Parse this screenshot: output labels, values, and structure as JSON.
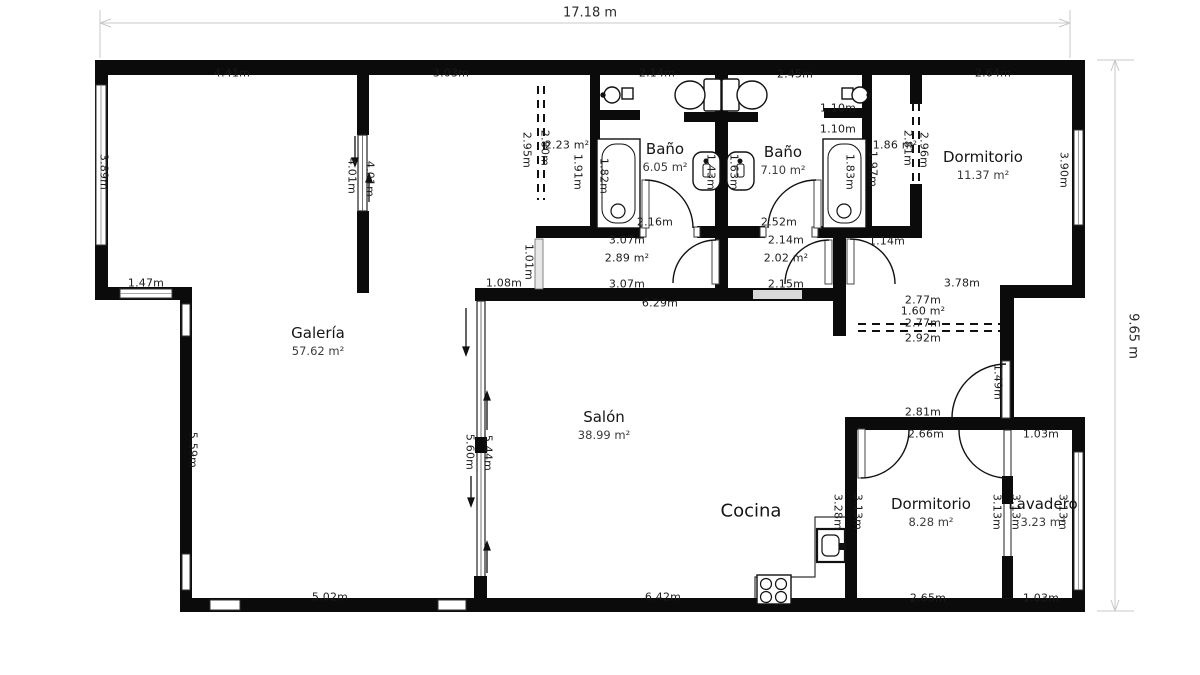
{
  "plan": {
    "overall": {
      "width_label": "17.18 m",
      "height_label": "9.65 m"
    },
    "colors": {
      "wall": "#0b0b0b",
      "dim_line": "#c8c8c8",
      "opening": "#d9d9d9"
    },
    "rooms": [
      {
        "name": "Galería",
        "area": "57.62 m²",
        "x": 318,
        "y": 341
      },
      {
        "name": "Baño",
        "area": "6.05 m²",
        "x": 665,
        "y": 157
      },
      {
        "name": "Baño",
        "area": "7.10 m²",
        "x": 783,
        "y": 160
      },
      {
        "name": "Dormitorio",
        "area": "11.37 m²",
        "x": 983,
        "y": 165
      },
      {
        "name": "Salón",
        "area": "38.99 m²",
        "x": 604,
        "y": 425
      },
      {
        "name": "Cocina",
        "area": "",
        "x": 751,
        "y": 511,
        "big": true
      },
      {
        "name": "Dormitorio",
        "area": "8.28 m²",
        "x": 931,
        "y": 512
      },
      {
        "name": "Lavadero",
        "area": "3.23 m²",
        "x": 1043,
        "y": 512
      }
    ],
    "dim_labels": [
      {
        "t": "4.41m",
        "x": 232,
        "y": 73
      },
      {
        "t": "3.03m",
        "x": 451,
        "y": 73
      },
      {
        "t": "2.14m",
        "x": 657,
        "y": 73
      },
      {
        "t": "2.45m",
        "x": 795,
        "y": 74
      },
      {
        "t": "2.64m",
        "x": 993,
        "y": 73
      },
      {
        "t": "2.23 m²",
        "x": 567,
        "y": 145
      },
      {
        "t": "2.95m",
        "x": 527,
        "y": 150,
        "r": 1
      },
      {
        "t": "2.80m",
        "x": 545,
        "y": 148,
        "r": 1
      },
      {
        "t": "1.91m",
        "x": 578,
        "y": 172,
        "r": 1
      },
      {
        "t": "1.82m",
        "x": 604,
        "y": 176,
        "r": 1
      },
      {
        "t": "4.01m",
        "x": 352,
        "y": 176,
        "r": 1
      },
      {
        "t": "4.01m",
        "x": 370,
        "y": 179,
        "r": 1
      },
      {
        "t": "3.89m",
        "x": 104,
        "y": 172,
        "r": 1
      },
      {
        "t": "1.10m",
        "x": 838,
        "y": 108
      },
      {
        "t": "1.10m",
        "x": 838,
        "y": 129
      },
      {
        "t": "1.86 m²",
        "x": 895,
        "y": 145
      },
      {
        "t": "1.43m",
        "x": 711,
        "y": 172,
        "r": 1
      },
      {
        "t": "1.63m",
        "x": 734,
        "y": 172,
        "r": 1
      },
      {
        "t": "1.83m",
        "x": 850,
        "y": 172,
        "r": 1
      },
      {
        "t": "1.97m",
        "x": 873,
        "y": 169,
        "r": 1
      },
      {
        "t": "2.81m",
        "x": 908,
        "y": 148,
        "r": 1
      },
      {
        "t": "2.96m",
        "x": 924,
        "y": 150,
        "r": 1
      },
      {
        "t": "3.90m",
        "x": 1064,
        "y": 170,
        "r": 1
      },
      {
        "t": "2.16m",
        "x": 655,
        "y": 222
      },
      {
        "t": "2.52m",
        "x": 779,
        "y": 222
      },
      {
        "t": "1.47m",
        "x": 146,
        "y": 283
      },
      {
        "t": "3.07m",
        "x": 627,
        "y": 240
      },
      {
        "t": "2.89 m²",
        "x": 627,
        "y": 258
      },
      {
        "t": "3.07m",
        "x": 627,
        "y": 284
      },
      {
        "t": "2.14m",
        "x": 786,
        "y": 240
      },
      {
        "t": "2.02 m²",
        "x": 786,
        "y": 258
      },
      {
        "t": "2.15m",
        "x": 786,
        "y": 284
      },
      {
        "t": "1.08m",
        "x": 504,
        "y": 283
      },
      {
        "t": "1.01m",
        "x": 529,
        "y": 262,
        "r": 1
      },
      {
        "t": "1.14m",
        "x": 887,
        "y": 241
      },
      {
        "t": "3.78m",
        "x": 962,
        "y": 283
      },
      {
        "t": "6.29m",
        "x": 660,
        "y": 303
      },
      {
        "t": "2.77m",
        "x": 923,
        "y": 300
      },
      {
        "t": "1.60 m²",
        "x": 923,
        "y": 311
      },
      {
        "t": "2.77m",
        "x": 923,
        "y": 323
      },
      {
        "t": "2.92m",
        "x": 923,
        "y": 338
      },
      {
        "t": "1.49m",
        "x": 998,
        "y": 382,
        "r": 1
      },
      {
        "t": "2.81m",
        "x": 923,
        "y": 412
      },
      {
        "t": "2.66m",
        "x": 926,
        "y": 434
      },
      {
        "t": "1.03m",
        "x": 1041,
        "y": 434
      },
      {
        "t": "5.59m",
        "x": 193,
        "y": 450,
        "r": 1
      },
      {
        "t": "5.60m",
        "x": 470,
        "y": 452,
        "r": 1
      },
      {
        "t": "5.44m",
        "x": 488,
        "y": 453,
        "r": 1
      },
      {
        "t": "3.28m",
        "x": 838,
        "y": 512,
        "r": 1
      },
      {
        "t": "3.13m",
        "x": 858,
        "y": 512,
        "r": 1
      },
      {
        "t": "3.13m",
        "x": 997,
        "y": 512,
        "r": 1
      },
      {
        "t": "3.13m",
        "x": 1016,
        "y": 512,
        "r": 1
      },
      {
        "t": "3.13m",
        "x": 1063,
        "y": 512,
        "r": 1
      },
      {
        "t": "5.02m",
        "x": 330,
        "y": 597
      },
      {
        "t": "6.42m",
        "x": 663,
        "y": 597
      },
      {
        "t": "2.65m",
        "x": 928,
        "y": 598
      },
      {
        "t": "1.03m",
        "x": 1041,
        "y": 598
      }
    ]
  }
}
